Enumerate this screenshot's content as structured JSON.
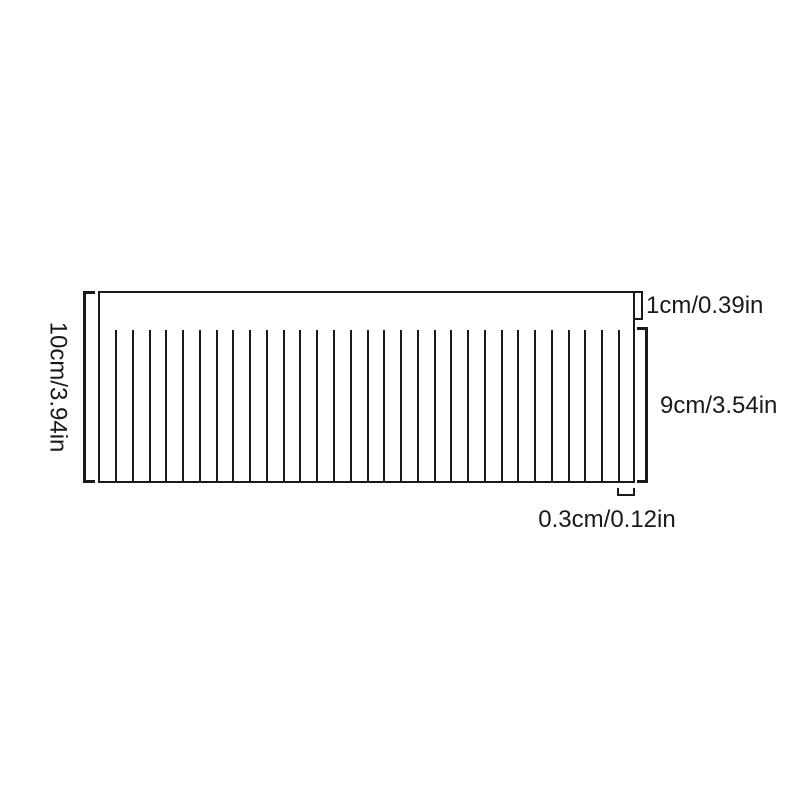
{
  "diagram": {
    "type": "product-dimension-diagram",
    "subject": "fringed rectangular sheet with solid top band and slit strips",
    "labels": {
      "total_height": "10cm/3.94in",
      "top_band_height": "1cm/0.39in",
      "fringe_height": "9cm/3.54in",
      "strip_width": "0.3cm/0.12in"
    },
    "fringe": {
      "line_count": 31
    },
    "colors": {
      "line": "#1a1a1a",
      "background": "#ffffff"
    }
  }
}
